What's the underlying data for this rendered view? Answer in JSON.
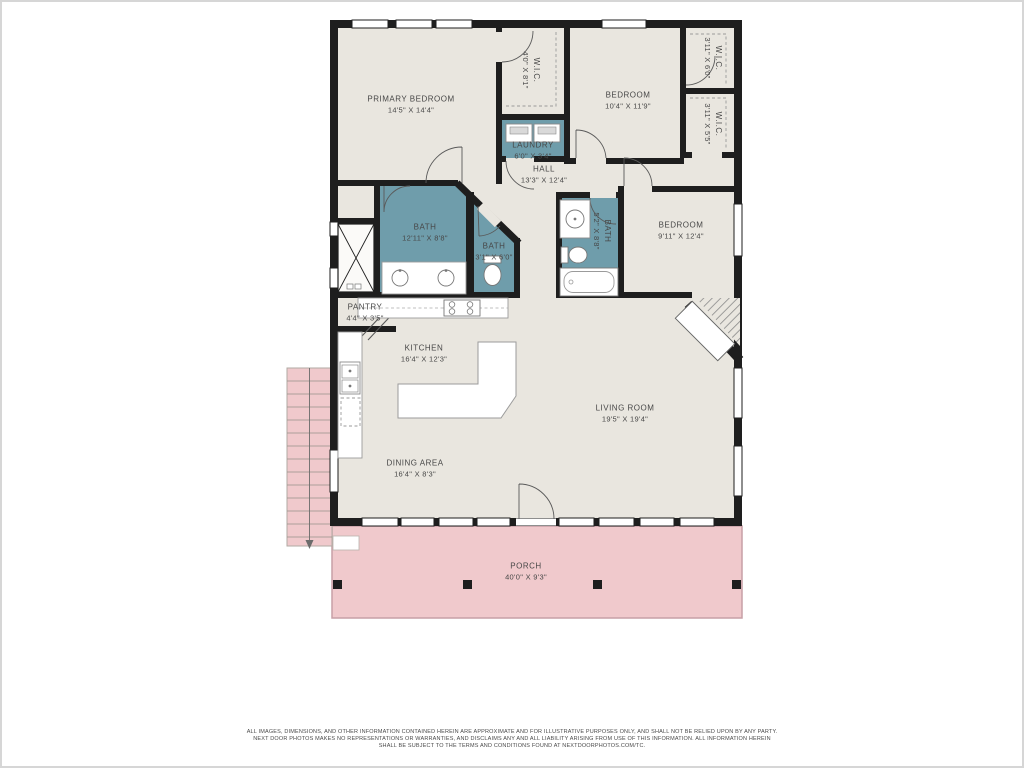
{
  "rooms": [
    {
      "name": "PRIMARY BEDROOM",
      "dims": "14'5\" X 14'4\""
    },
    {
      "name": "W.I.C.",
      "dims": "4'0\" X 8'1\""
    },
    {
      "name": "BEDROOM",
      "dims": "10'4\" X 11'9\""
    },
    {
      "name": "W.I.C.",
      "dims": "3'11\" X 6'0\""
    },
    {
      "name": "W.I.C.",
      "dims": "3'11\" X 5'5\""
    },
    {
      "name": "LAUNDRY",
      "dims": "6'0\" X 3'4\""
    },
    {
      "name": "HALL",
      "dims": "13'3\" X 12'4\""
    },
    {
      "name": "BATH",
      "dims": "12'11\" X 8'8\""
    },
    {
      "name": "BATH",
      "dims": "3'1\" X 6'0\""
    },
    {
      "name": "BATH",
      "dims": "5'2\" X 8'8\""
    },
    {
      "name": "BEDROOM",
      "dims": "9'11\" X 12'4\""
    },
    {
      "name": "PANTRY",
      "dims": "4'4\" X 3'5\""
    },
    {
      "name": "KITCHEN",
      "dims": "16'4\" X 12'3\""
    },
    {
      "name": "LIVING ROOM",
      "dims": "19'5\" X 19'4\""
    },
    {
      "name": "DINING AREA",
      "dims": "16'4\" X 8'3\""
    },
    {
      "name": "PORCH",
      "dims": "40'0\" X 9'3\""
    }
  ],
  "disclaimer": {
    "line1": "ALL IMAGES, DIMENSIONS, AND OTHER INFORMATION CONTAINED HEREIN ARE APPROXIMATE AND FOR ILLUSTRATIVE PURPOSES ONLY, AND SHALL NOT BE RELIED UPON BY ANY PARTY.",
    "line2": "NEXT DOOR PHOTOS MAKES NO REPRESENTATIONS OR WARRANTIES, AND DISCLAIMS ANY AND ALL LIABILITY ARISING FROM USE OF THIS INFORMATION. ALL INFORMATION HEREIN",
    "line3": "SHALL BE SUBJECT TO THE TERMS AND CONDITIONS FOUND AT NEXTDOORPHOTOS.COM/TC."
  },
  "colors": {
    "wall": "#1e1e1e",
    "room_fill": "#e9e6df",
    "wet_room_fill": "#6f9dab",
    "porch_fill": "#f0c9cc",
    "label_text": "#474747"
  }
}
